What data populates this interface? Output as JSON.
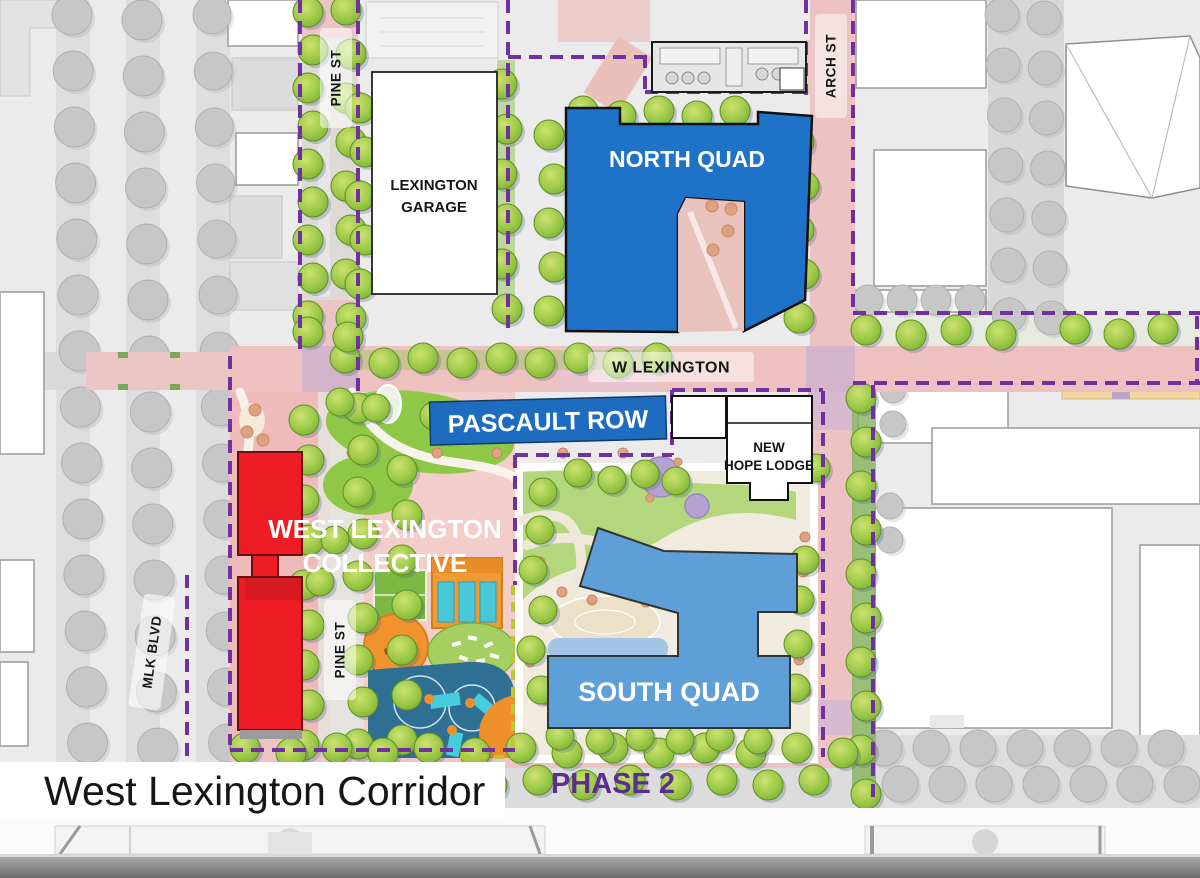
{
  "title": "West Lexington Corridor",
  "streets": {
    "pine_st_north": "PINE ST",
    "arch_st": "ARCH ST",
    "w_lexington": "W LEXINGTON",
    "mlk_blvd": "MLK BLVD",
    "pine_st_south": "PINE ST"
  },
  "buildings": {
    "lexington_garage": {
      "line1": "LEXINGTON",
      "line2": "GARAGE",
      "fill": "#ffffff"
    },
    "north_quad": {
      "label": "NORTH QUAD",
      "fill": "#1e73c8"
    },
    "pascault_row": {
      "label": "PASCAULT ROW",
      "fill": "#1d6cc0"
    },
    "new_hope_lodge": {
      "line1": "NEW",
      "line2": "HOPE LODGE",
      "fill": "#ffffff"
    },
    "west_lexington_collective": {
      "line1": "WEST LEXINGTON",
      "line2": "COLLECTIVE",
      "fill": "#ee1c24"
    },
    "south_quad": {
      "label": "SOUTH QUAD",
      "fill": "#5f9fd7"
    }
  },
  "phase": {
    "label": "PHASE 2",
    "color": "#5c2d91"
  },
  "boundary": {
    "color": "#7030a0",
    "phase_line_color": "#bcc733"
  }
}
